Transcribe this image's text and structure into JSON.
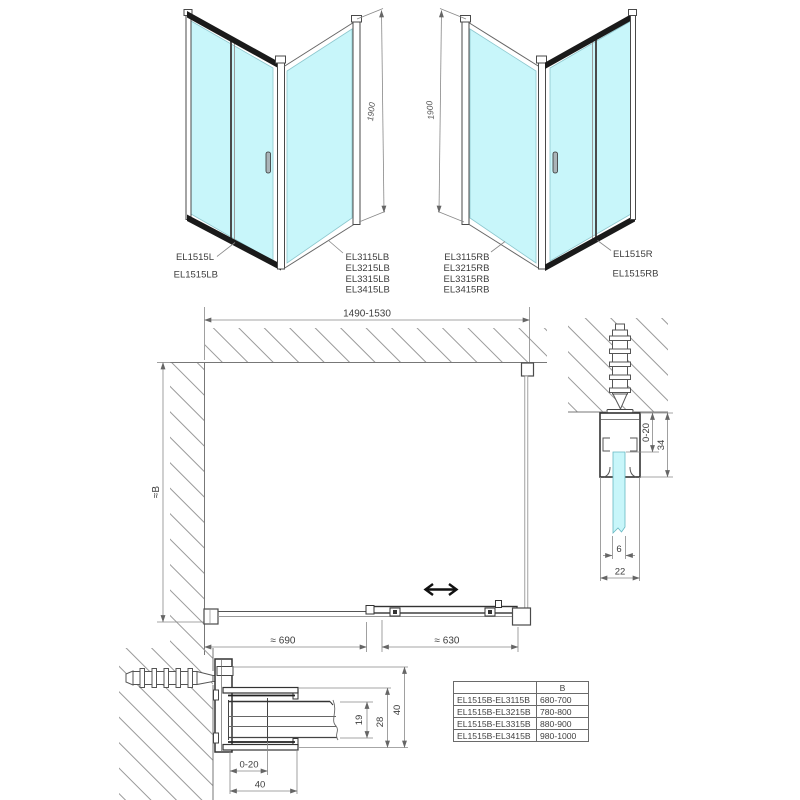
{
  "drawing": {
    "iso_left": {
      "height_dim": "1900",
      "door_labels": [
        "EL1515L",
        "EL1515LB"
      ],
      "panel_labels": [
        "EL3115LB",
        "EL3215LB",
        "EL3315LB",
        "EL3415LB"
      ]
    },
    "iso_right": {
      "height_dim": "1900",
      "panel_labels": [
        "EL3115RB",
        "EL3215RB",
        "EL3315RB",
        "EL3415RB"
      ],
      "door_labels": [
        "EL1515R",
        "EL1515RB"
      ]
    },
    "plan": {
      "width_dim": "1490-1530",
      "depth_dim": "≈B",
      "fixed_part_dim": "≈ 690",
      "door_part_dim": "≈ 630"
    },
    "top_profile_section": {
      "adjust_dim": "0-20",
      "profile_height_dim": "34",
      "glass_thickness_dim": "6",
      "profile_width_dim": "22"
    },
    "wall_profile_section": {
      "adjust_dim": "0-20",
      "profile_width_dim": "40",
      "glass_gap_dim": "19",
      "inner_depth_dim": "28",
      "profile_depth_dim": "40"
    },
    "size_table": {
      "b_header": "B",
      "rows": [
        {
          "models": "EL1515B-EL3115B",
          "b": "680-700"
        },
        {
          "models": "EL1515B-EL3215B",
          "b": "780-800"
        },
        {
          "models": "EL1515B-EL3315B",
          "b": "880-900"
        },
        {
          "models": "EL1515B-EL3415B",
          "b": "980-1000"
        }
      ]
    },
    "colors": {
      "glass": "#c8f6fa",
      "frame_dark": "#1a1a1a",
      "profile_line": "#3a3a3a",
      "dimension_line": "#888888",
      "hatch": "#9a9a9a",
      "text": "#3d3d3d"
    }
  }
}
